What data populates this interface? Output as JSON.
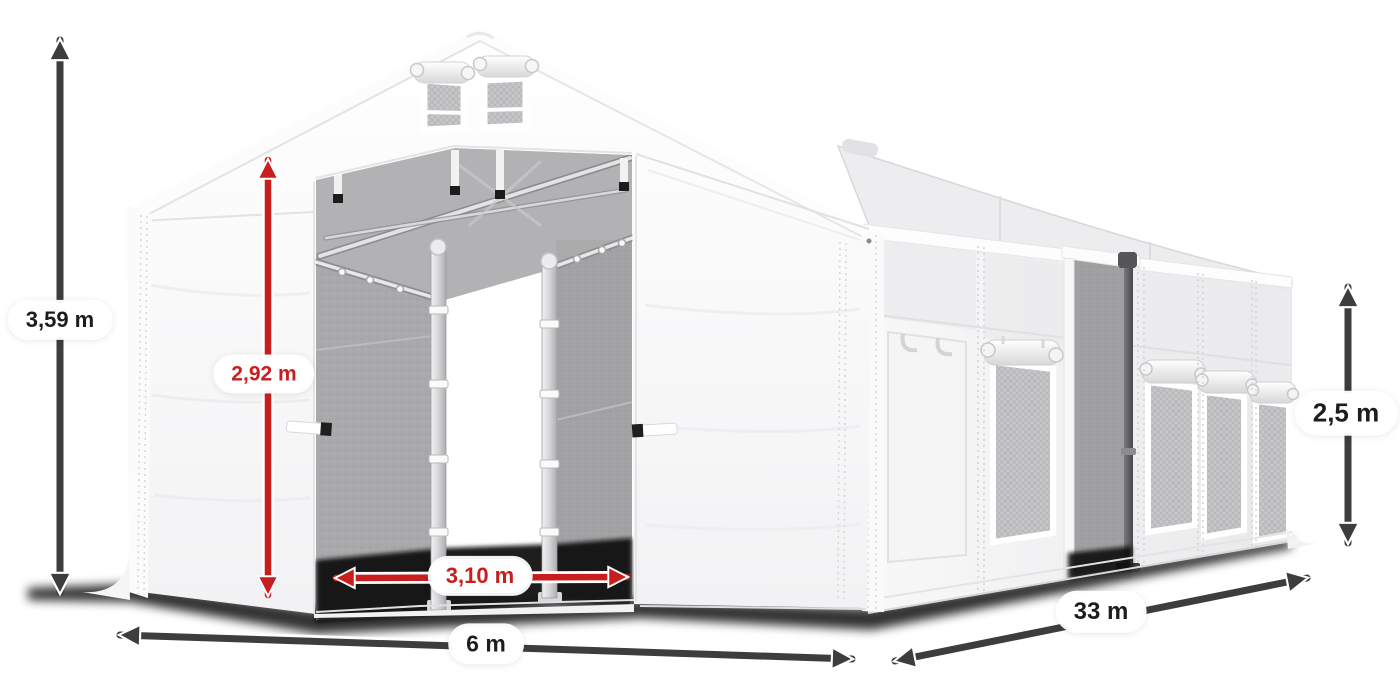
{
  "diagram": {
    "subject": "storage-tent-dimension-diagram",
    "dimensions": {
      "total_height": {
        "label": "3,59 m",
        "style": "dark"
      },
      "door_height": {
        "label": "2,92 m",
        "style": "red"
      },
      "door_width": {
        "label": "3,10 m",
        "style": "red"
      },
      "width": {
        "label": "6 m",
        "style": "dark"
      },
      "length": {
        "label": "33 m",
        "style": "dark"
      },
      "side_height": {
        "label": "2,5 m",
        "style": "dark"
      }
    },
    "colors": {
      "background": "#ffffff",
      "arrow_dark": "#3d3d3d",
      "arrow_red": "#c81e1e",
      "label_text_dark": "#1d1d1d",
      "label_text_red": "#c81e1e",
      "label_pill_bg": "#ffffff",
      "tent_fabric": "#f7f7f8",
      "interior_gray": "#a9a9ab",
      "shadow": "#000000"
    }
  }
}
